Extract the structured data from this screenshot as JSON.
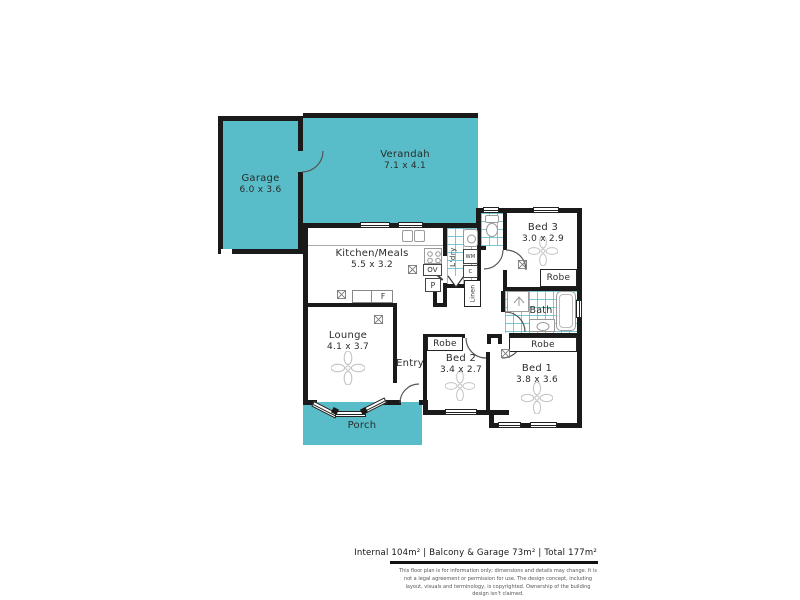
{
  "colors": {
    "accent": "#58bdc9",
    "wall": "#1a1a1a",
    "text": "#2b2b2b",
    "fixture": "#9a9a9a"
  },
  "rooms": {
    "garage": {
      "name": "Garage",
      "dims": "6.0 x 3.6"
    },
    "verandah": {
      "name": "Verandah",
      "dims": "7.1 x 4.1"
    },
    "kitchen": {
      "name": "Kitchen/Meals",
      "dims": "5.5 x 3.2"
    },
    "lounge": {
      "name": "Lounge",
      "dims": "4.1 x 3.7"
    },
    "entry": {
      "name": "Entry"
    },
    "porch": {
      "name": "Porch"
    },
    "bed1": {
      "name": "Bed 1",
      "dims": "3.8 x 3.6"
    },
    "bed2": {
      "name": "Bed 2",
      "dims": "3.4 x 2.7"
    },
    "bed3": {
      "name": "Bed 3",
      "dims": "3.0 x 2.9"
    },
    "bath": {
      "name": "Bath"
    }
  },
  "labels": {
    "robe": "Robe",
    "laundry": "L'dry",
    "linen": "Linen",
    "washing_machine": "WM",
    "cupboard": "C",
    "oven": "OV",
    "pantry": "P",
    "fridge": "F"
  },
  "footer": {
    "summary": "Internal 104m²  |  Balcony & Garage 73m² | Total 177m²",
    "disclaimer": "This floor plan is for information only; dimensions and details may change. It is not a legal agreement or permission for use. The design concept, including layout, visuals and terminology, is copyrighted. Ownership of the building design isn't claimed."
  }
}
